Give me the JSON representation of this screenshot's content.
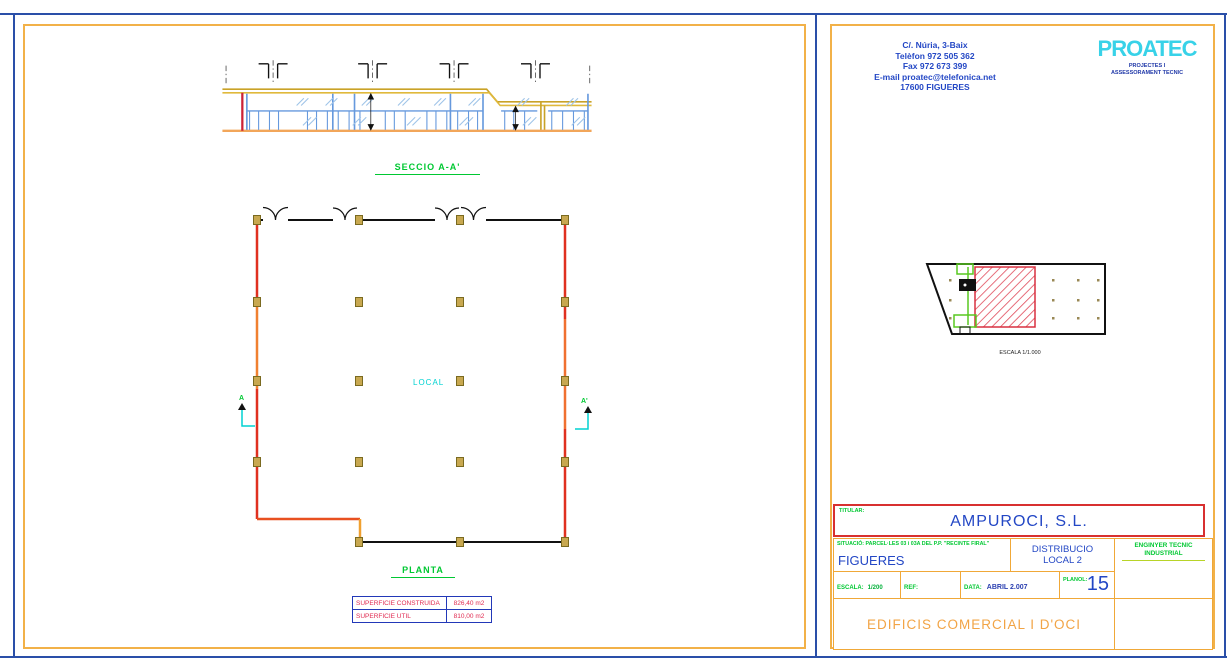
{
  "left_sheet": {
    "section_label": "SECCIO A-A'",
    "plan_label": "PLANTA",
    "room_label": "LOCAL",
    "section_marker_start": "A",
    "section_marker_end": "A'",
    "area_table": {
      "rows": [
        {
          "label": "SUPERFICIE CONSTRUIDA",
          "value": "826,40 m2"
        },
        {
          "label": "SUPERFICIE UTIL",
          "value": "810,00 m2"
        }
      ]
    }
  },
  "right_sheet": {
    "company": {
      "lines": [
        "C/. Núria, 3-Baix",
        "Telèfon 972 505 362",
        "Fax 972 673 399",
        "E-mail proatec@telefonica.net",
        "17600  FIGUERES"
      ]
    },
    "logo": {
      "name": "PROATEC",
      "tagline1": "PROJECTES I",
      "tagline2": "ASSESSORAMENT TECNIC"
    },
    "key_plan_scale": "ESCALA 1/1.000",
    "title_block": {
      "titular_label": "TITULAR:",
      "titular_value": "AMPUROCI, S.L.",
      "situacio": "SITUACIÓ: PARCEL·LES 03 i 03A DEL P.P. \"RECINTE FIRAL\"",
      "city": "FIGUERES",
      "drawing_title1": "DISTRIBUCIO",
      "drawing_title2": "LOCAL 2",
      "engineer1": "ENGINYER TECNIC",
      "engineer2": "INDUSTRIAL",
      "escala_label": "ESCALA:",
      "escala_value": "1/200",
      "ref_label": "REF:",
      "data_label": "DATA:",
      "data_value": "ABRIL 2.007",
      "planol_label": "PLANOL:",
      "planol_value": "15",
      "project_title": "EDIFICIS COMERCIAL I D'OCI"
    }
  },
  "colors": {
    "frame_blue": "#2a4fa8",
    "sheet_border": "#f2b148",
    "wall_red": "#e03020",
    "wall_orange": "#f08030",
    "column_tan": "#c8a850",
    "cad_green": "#00c832",
    "cad_cyan": "#00d2d2",
    "text_blue": "#2347c5",
    "logo_cyan": "#38d2e8",
    "table_red": "#e02a50",
    "hatch_red": "#e04858",
    "project_orange": "#f2a445"
  }
}
